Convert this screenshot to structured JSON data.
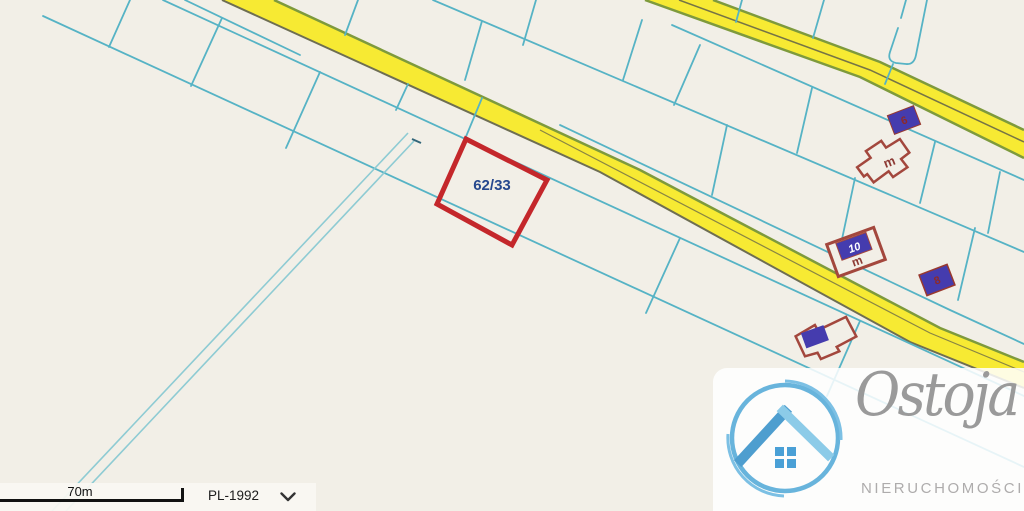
{
  "map": {
    "selected_parcel": {
      "label": "62/33"
    },
    "address_badges": [
      {
        "label": "6"
      },
      {
        "label": "8"
      }
    ],
    "buildings": [
      {
        "label": "m"
      },
      {
        "label": "10",
        "sublabel": "m"
      }
    ],
    "colors": {
      "background": "#f2efe7",
      "boundary_line": "#56b3c5",
      "ditch_line": "#8ecbd3",
      "road_fill": "#f7ea33",
      "road_edge": "#7e9a3c",
      "parcel_outline": "#c4272b",
      "parcel_label": "#26488e",
      "building_outline": "#a3473d",
      "badge_fill": "#453cae",
      "logo_blue": "#58acd8"
    }
  },
  "controls": {
    "scale_label": "70m",
    "crs_selector": {
      "value": "PL-1992"
    }
  },
  "watermark": {
    "brand": "Ostoja",
    "subtitle": "NIERUCHOMOŚCI"
  }
}
